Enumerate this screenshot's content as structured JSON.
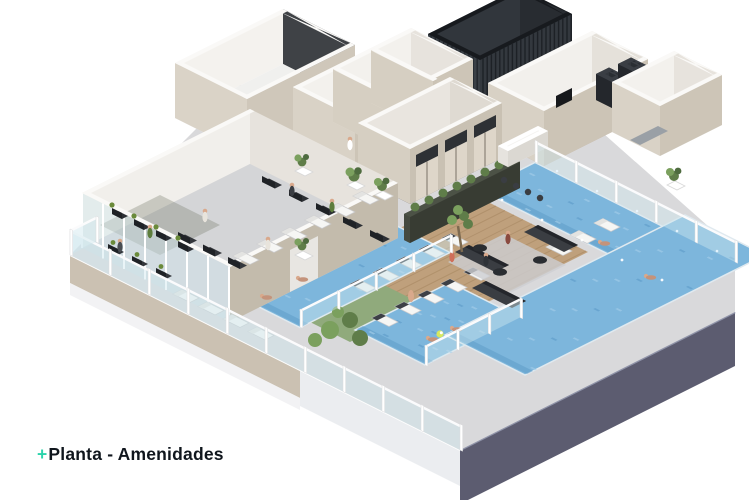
{
  "caption": {
    "plus": "+",
    "title": "Planta - Amenidades",
    "accent_color": "#2bd3ab",
    "text_color": "#10161d"
  },
  "palette": {
    "background": "#ffffff",
    "pool_water": "#7db6dc",
    "pool_water_deep": "#5f9cc9",
    "pool_water_light": "#a3cde8",
    "wood_deck": "#bfa07c",
    "wood_deck_line": "#a5855f",
    "terrace_tile": "#d9d9db",
    "wall_beige": "#cfc7b9",
    "wall_beige_shade": "#c3bbac",
    "wall_white": "#f0eeea",
    "wall_cap": "#faf9f7",
    "interior_floor": "#ecebe8",
    "gym_floor": "#d4d5d7",
    "dark_louver": "#3a4046",
    "dark_panel": "#3f4246",
    "slab_dark": "#5c5c70",
    "slab_light": "#ebedf0",
    "facade_beige": "#cbc1b2",
    "glass": "#cfe6ee",
    "railing_white": "#fbfbfc",
    "plant_green": "#5f7d49",
    "plant_green_light": "#7ba05e",
    "sofa_dark": "#3a3d42",
    "lounger_white": "#f6f6f4",
    "lounger_pad_dark": "#3d4046",
    "skin": "#d9a98c",
    "ball_green": "#d6e85e"
  },
  "areas": [
    "building-slab",
    "gym",
    "fitness-studio",
    "changing-rooms",
    "elevator-core",
    "mechanical-louver-room",
    "bar-kitchen",
    "corner-room",
    "lounge",
    "wood-deck",
    "garden",
    "pool-left",
    "pool-center",
    "infinity-pool",
    "sun-loungers",
    "glass-railing",
    "plants",
    "people"
  ]
}
